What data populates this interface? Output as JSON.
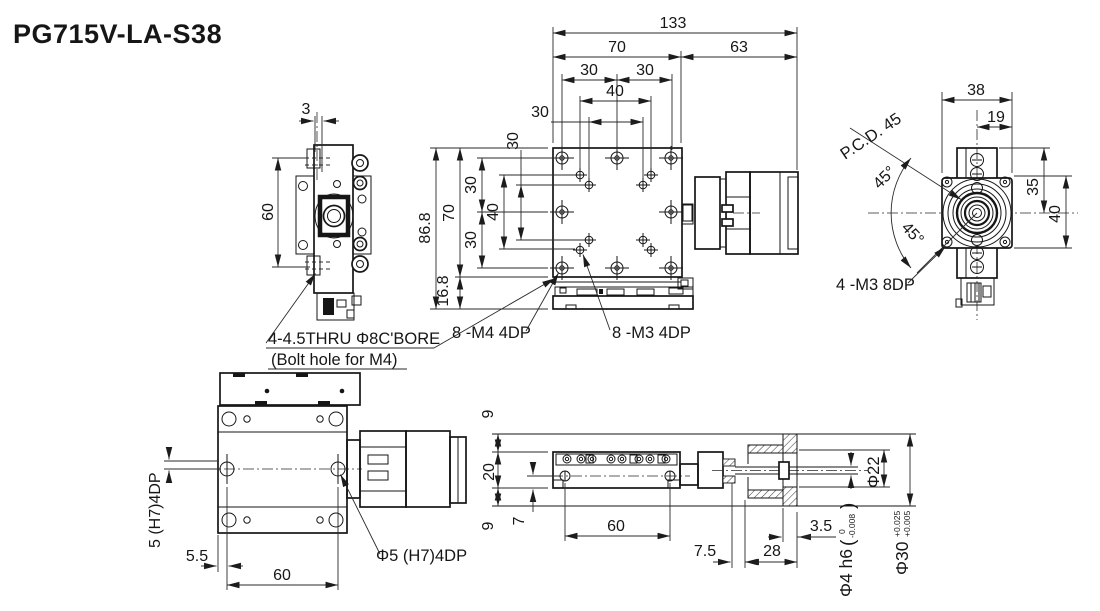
{
  "title": "PG715V-LA-S38",
  "side_view": {
    "offset": "3",
    "hole_span": "60"
  },
  "plan_view": {
    "overall": "133",
    "body": "70",
    "motor": "63",
    "col_left": "30",
    "col_right": "30",
    "col_inner": "40",
    "col_pair": "30",
    "row_pair": "30",
    "height_total": "86.8",
    "height_body": "70",
    "row_top": "30",
    "row_mid": "40",
    "row_bot": "30",
    "height_base": "16.8"
  },
  "callouts": {
    "thru": "4-4.5THRU Φ8C'BORE",
    "thru_sub": "(Bolt hole for M4)",
    "m4": "8 -M4 4DP",
    "m3": "8 -M3 4DP"
  },
  "end_view": {
    "width": "38",
    "half_width": "19",
    "center_top": "35",
    "height": "40",
    "pcd": "P.C.D. 45",
    "angle_upper": "45°",
    "angle_lower": "45°",
    "m3": "4 -M3 8DP"
  },
  "bottom_view": {
    "pin_note": "5 (H7)4DP",
    "edge_offset": "5.5",
    "pin_span": "60",
    "pin_label": "Φ5 (H7)4DP"
  },
  "section_view": {
    "offset_top": "9",
    "body_h": "20",
    "offset_bot": "9",
    "pin_depth": "7",
    "pin_span": "60",
    "gap": "7.5",
    "flange_len": "28",
    "disc_t": "3.5",
    "bore": "Φ22",
    "shaft": "Φ4 h6",
    "paren_l": "(",
    "shaft_tol_u": "0",
    "shaft_tol_l": "-0.008",
    "paren_r": ")",
    "od": "Φ30",
    "od_tol_u": "+0.025",
    "od_tol_l": "+0.005"
  }
}
